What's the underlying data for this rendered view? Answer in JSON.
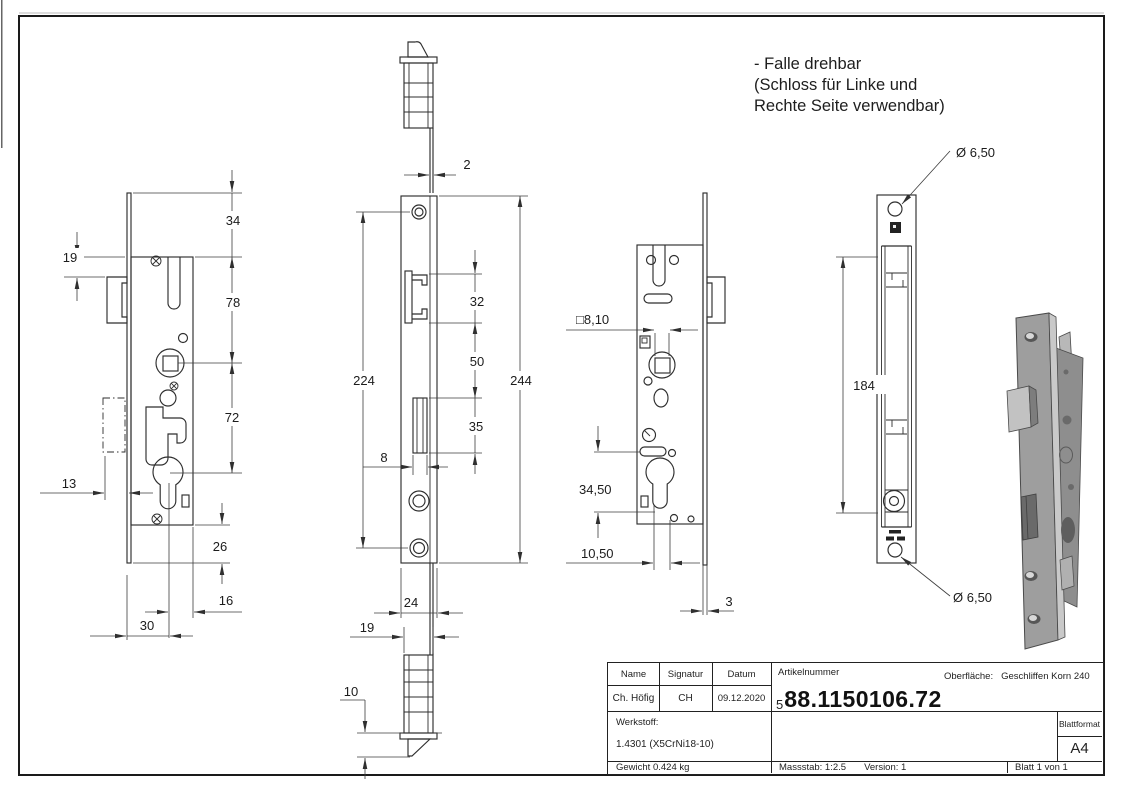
{
  "note": {
    "lines": [
      "- Falle drehbar",
      "(Schloss für Linke und",
      "Rechte Seite verwendbar)"
    ]
  },
  "dims": {
    "d34": "34",
    "d19": "19",
    "d78": "78",
    "d72": "72",
    "d13": "13",
    "d26": "26",
    "d16": "16",
    "d30": "30",
    "d2": "2",
    "d224": "224",
    "d244": "244",
    "d32": "32",
    "d50": "50",
    "d35": "35",
    "d8": "8",
    "d24": "24",
    "d19b": "19",
    "d10": "10",
    "d810": "□8,10",
    "d3450": "34,50",
    "d1050": "10,50",
    "d3": "3",
    "d184": "184",
    "d650_top": "Ø 6,50",
    "d650_bottom": "Ø 6,50"
  },
  "title_block": {
    "name_label": "Name",
    "signatur_label": "Signatur",
    "datum_label": "Datum",
    "name": "Ch. Höfig",
    "signatur": "CH",
    "datum": "09.12.2020",
    "artikelnummer_label": "Artikelnummer",
    "artikelnummer_prefix": "5",
    "artikelnummer": "88.1150106.72",
    "oberflaeche_label": "Oberfläche:",
    "oberflaeche": "Geschliffen Korn 240",
    "werkstoff_label": "Werkstoff:",
    "werkstoff": "1.4301 (X5CrNi18-10)",
    "gewicht": "Gewicht 0.424 kg",
    "massstab": "Massstab: 1:2.5",
    "version": "Version: 1",
    "blatt": "Blatt 1 von 1",
    "blattformat_label": "Blattformat",
    "blattformat": "A4"
  },
  "colors": {
    "line": "#2e2e2e",
    "render_body": "#9e9e9e",
    "render_edge": "#c9c9c9",
    "render_dark": "#5e5e5e"
  }
}
